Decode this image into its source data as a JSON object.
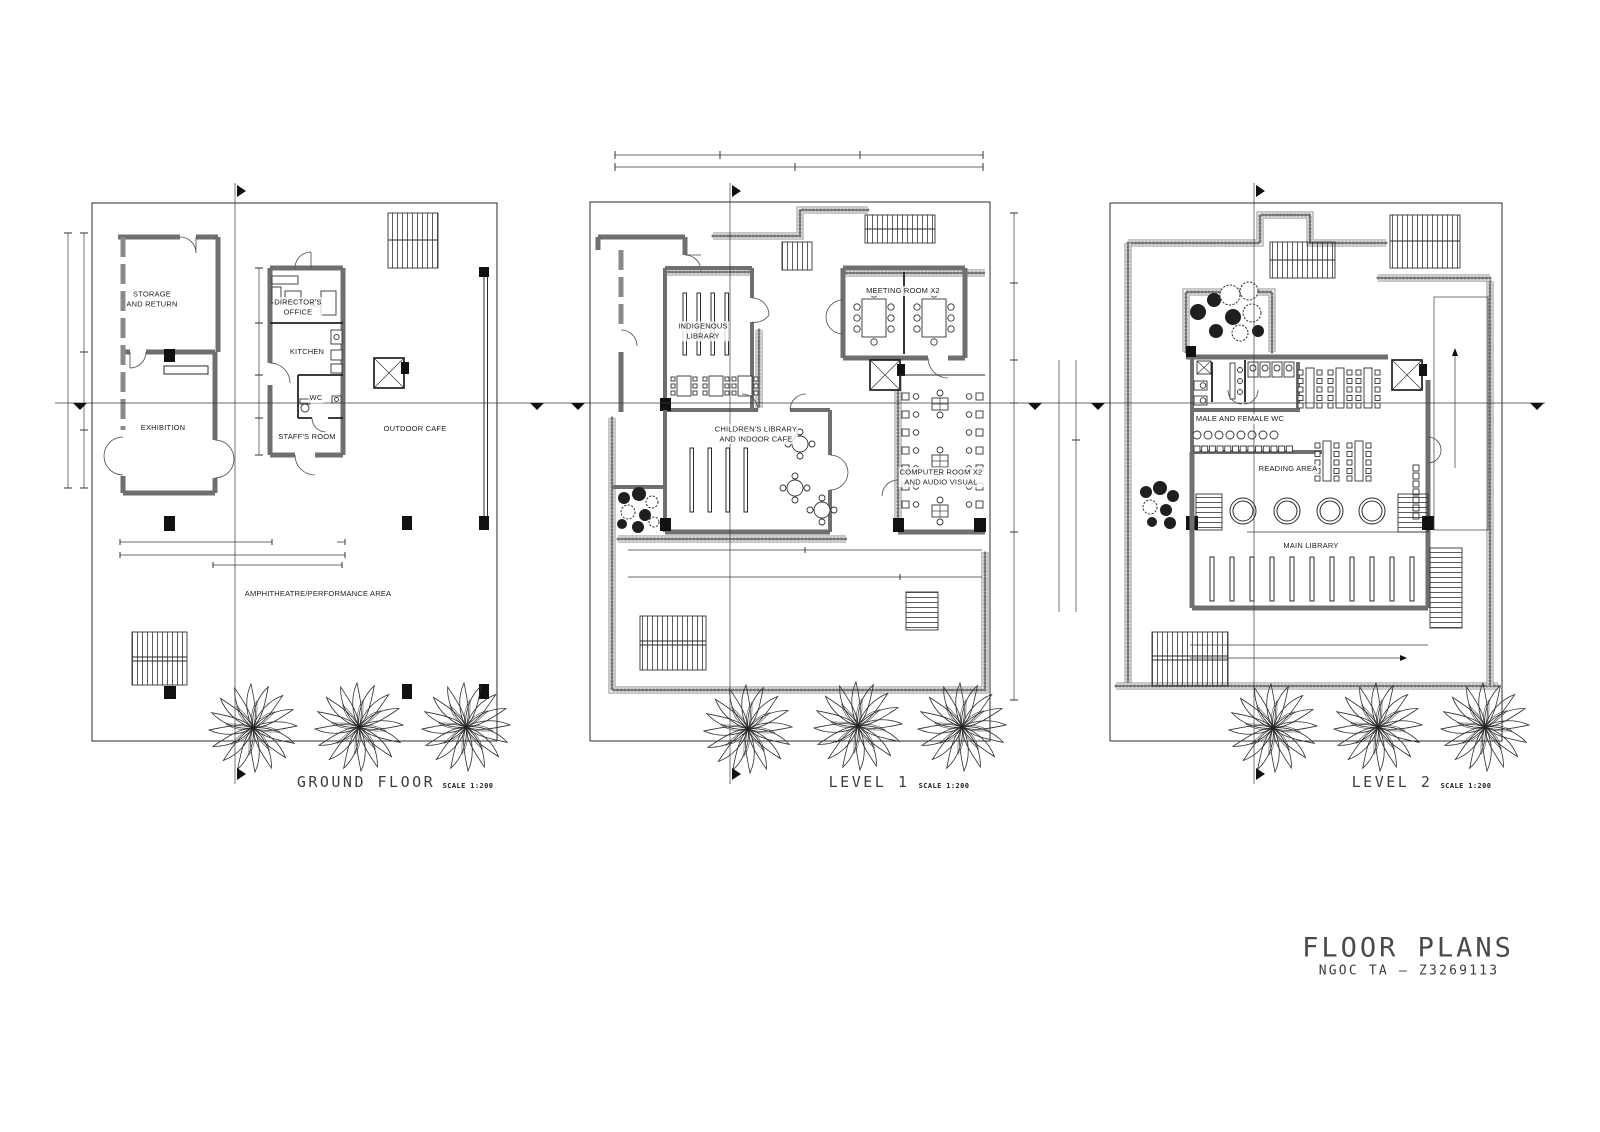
{
  "sheet": {
    "title": "FLOOR PLANS",
    "author": "NGOC TA – Z3269113"
  },
  "colors": {
    "paper": "#ffffff",
    "ink": "#1a1a1a",
    "wall_gray": "#6f6f6f"
  },
  "plans": [
    {
      "id": "ground-floor",
      "title": "GROUND FLOOR",
      "scale": "SCALE 1:200",
      "rooms": {
        "storage": "STORAGE\nAND RETURN",
        "directors_office": "DIRECTOR'S\nOFFICE",
        "kitchen": "KITCHEN",
        "wc": "WC",
        "staffs_room": "STAFF'S ROOM",
        "exhibition": "EXHIBITION",
        "outdoor_cafe": "OUTDOOR CAFE",
        "amphitheatre": "AMPHITHEATRE/PERFORMANCE AREA"
      }
    },
    {
      "id": "level-1",
      "title": "LEVEL 1",
      "scale": "SCALE 1:200",
      "rooms": {
        "indigenous_library": "INDIGENOUS\nLIBRARY",
        "meeting_room": "MEETING ROOM X2",
        "childrens_library": "CHILDREN'S LIBRARY\nAND INDOOR CAFE",
        "computer_room": "COMPUTER ROOM X2\nAND AUDIO VISUAL"
      }
    },
    {
      "id": "level-2",
      "title": "LEVEL 2",
      "scale": "SCALE 1:200",
      "rooms": {
        "wc": "MALE AND FEMALE WC",
        "reading_area": "READING AREA",
        "main_library": "MAIN LIBRARY"
      }
    }
  ]
}
